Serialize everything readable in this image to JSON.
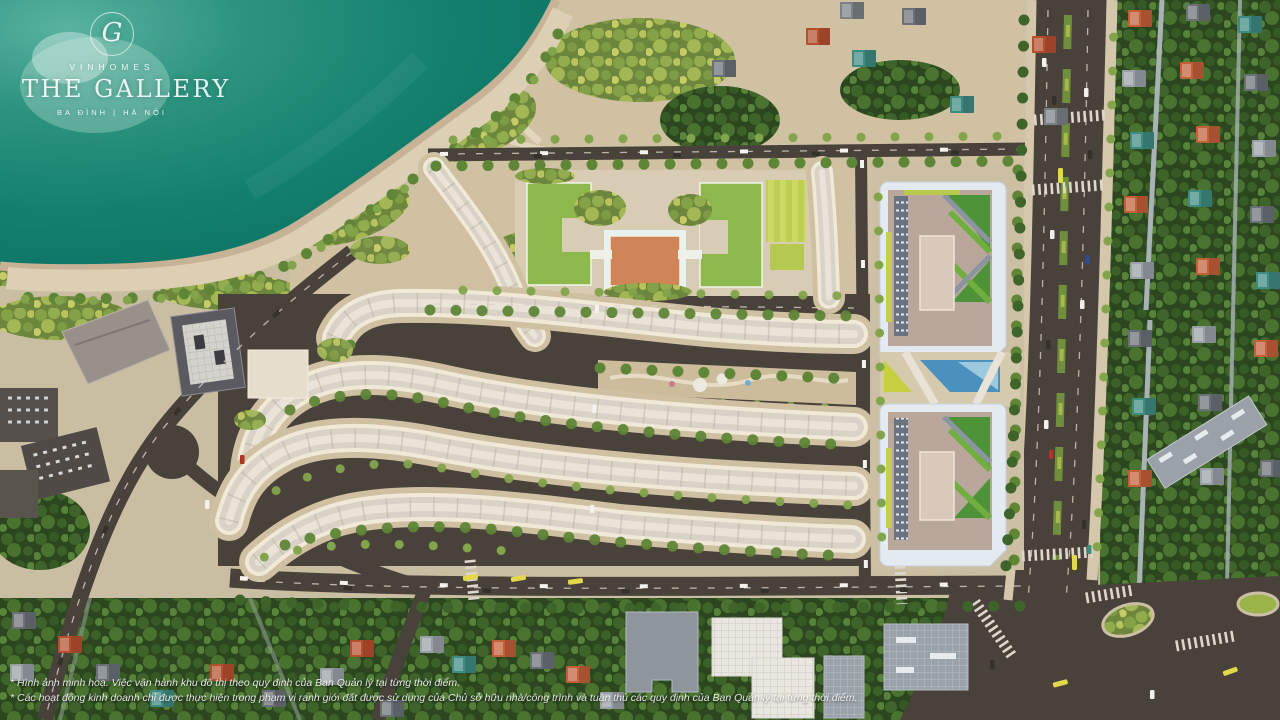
{
  "overlay": {
    "logo": {
      "monogram": "G",
      "brand": "VINHOMES",
      "project": "THE GALLERY",
      "location": "BA ĐÌNH | HÀ NỘI"
    },
    "disclaimer": {
      "line1": "* Hình ảnh minh hoạ. Việc vận hành khu đô thị theo quy định của Ban Quản lý tại từng thời điểm.",
      "line2": "* Các hoạt động kinh doanh chỉ được thực hiện trong phạm vi ranh giới đất được sử dụng của Chủ sở hữu nhà/công trình và tuân thủ các quy định của Ban Quản lý tại từng thời điểm."
    }
  },
  "scene": {
    "type": "aerial-masterplan-render",
    "colors": {
      "lake": "#13806e",
      "lake_glint": "#bfe2d8",
      "shore_embankment": "#c8b295",
      "promenade": "#dccfb4",
      "ground": "#c9bda2",
      "road": "#49423b",
      "shophouse_wall": "#f1e9d8",
      "shophouse_roof": "#d9d2c6",
      "school_roof_green": "#8db84b",
      "school_roof_orange": "#cf8557",
      "sports_lawn": "#c6d35b",
      "tree_dark": "#2c4720",
      "tree_warm": "#6d863d",
      "tower_frame": "#e3ebf1",
      "tower_deck": "#b8a79a",
      "roof_garden": "#4f9339",
      "pool_blue": "#4a92bd",
      "villa_orange": "#c2603a",
      "villa_teal": "#3e8b82",
      "villa_slate": "#6b7077",
      "bus_yellow": "#e3d84b"
    }
  }
}
